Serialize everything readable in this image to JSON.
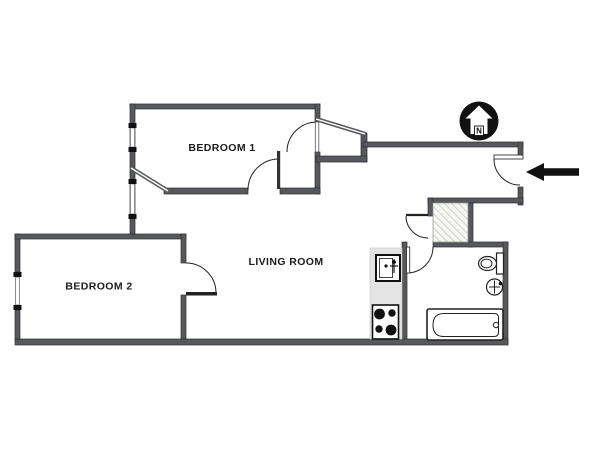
{
  "plan": {
    "rooms": {
      "bedroom1": {
        "label": "BEDROOM 1"
      },
      "bedroom2": {
        "label": "BEDROOM 2"
      },
      "living_room": {
        "label": "LIVING ROOM"
      }
    },
    "compass": {
      "letter": "N"
    },
    "icons": {
      "north": "north-compass-icon",
      "entry": "entry-arrow-icon"
    },
    "colors": {
      "wall": "#56585c",
      "wall_edge": "#2f3033",
      "line": "#222222",
      "hatch_line": "#c3c8ba",
      "hatch_bg": "#f6f7f3",
      "counter": "#e4e4e4",
      "fixture_fill": "#ffffff",
      "black": "#111111",
      "background": "#ffffff"
    }
  }
}
